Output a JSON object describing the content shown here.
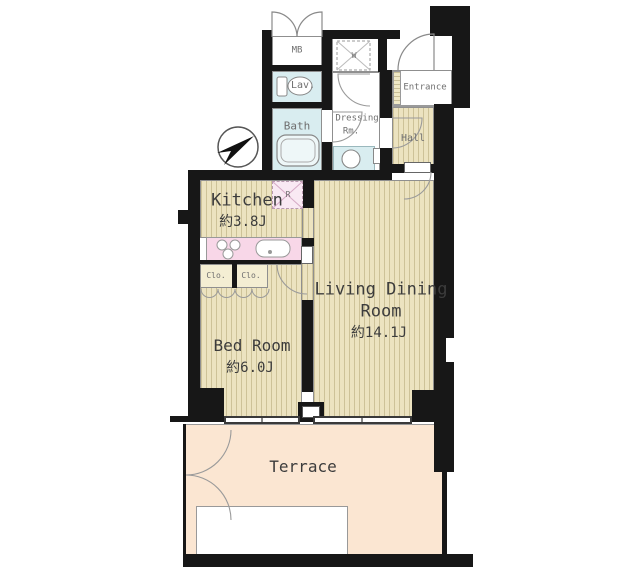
{
  "plan": {
    "rooms": {
      "kitchen": {
        "name": "Kitchen",
        "area": "約3.8J"
      },
      "living_dining": {
        "name_line1": "Living Dining",
        "name_line2": "Room",
        "area": "約14.1J"
      },
      "bedroom": {
        "name": "Bed Room",
        "area": "約6.0J"
      },
      "terrace": {
        "name": "Terrace"
      },
      "bath": {
        "name": "Bath"
      },
      "lavatory": {
        "name": "Lav."
      },
      "dressing": {
        "name_line1": "Dressing",
        "name_line2": "Rm."
      },
      "entrance": {
        "name": "Entrance"
      },
      "hall": {
        "name": "Hall"
      }
    },
    "fixtures": {
      "meter_box": "MB",
      "washing_machine": "W",
      "refrigerator": "R",
      "closet_left": "Clo.",
      "closet_right": "Clo."
    },
    "colors": {
      "wall": "#171717",
      "wood_flooring": "#ece3c0",
      "wet_area": "#d9edf0",
      "kitchen_counter": "#f8d7e8",
      "terrace": "#fbe6d2"
    }
  }
}
